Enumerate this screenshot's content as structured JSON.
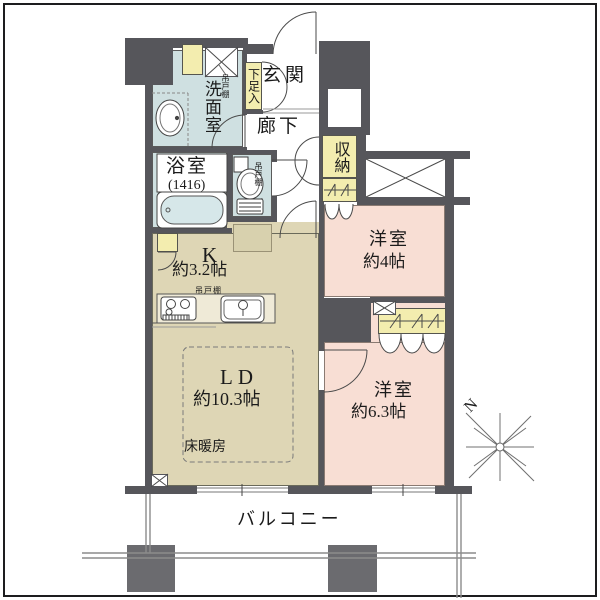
{
  "plan": {
    "entrance": "玄関",
    "hallway": "廊下",
    "shoe_cabinet": "下足入",
    "washroom": "洗面室",
    "hanging_cupboard": "吊戸棚",
    "bathroom": {
      "name": "浴室",
      "size": "(1416)"
    },
    "storage": "収納",
    "kitchen": {
      "name": "K",
      "size": "約3.2帖"
    },
    "living": {
      "name": "LD",
      "size": "約10.3帖",
      "floor_heating": "床暖房"
    },
    "bedroom_4": {
      "name": "洋室",
      "size": "約4帖"
    },
    "bedroom_63": {
      "name": "洋室",
      "size": "約6.3帖"
    },
    "balcony": "バルコニー",
    "compass_north": "N"
  },
  "colors": {
    "wall": "#56565b",
    "wet_area": "#cfe0e1",
    "kitchen_living": "#ded6b5",
    "bedroom": "#f8ded4",
    "closet": "#f3edaf"
  }
}
